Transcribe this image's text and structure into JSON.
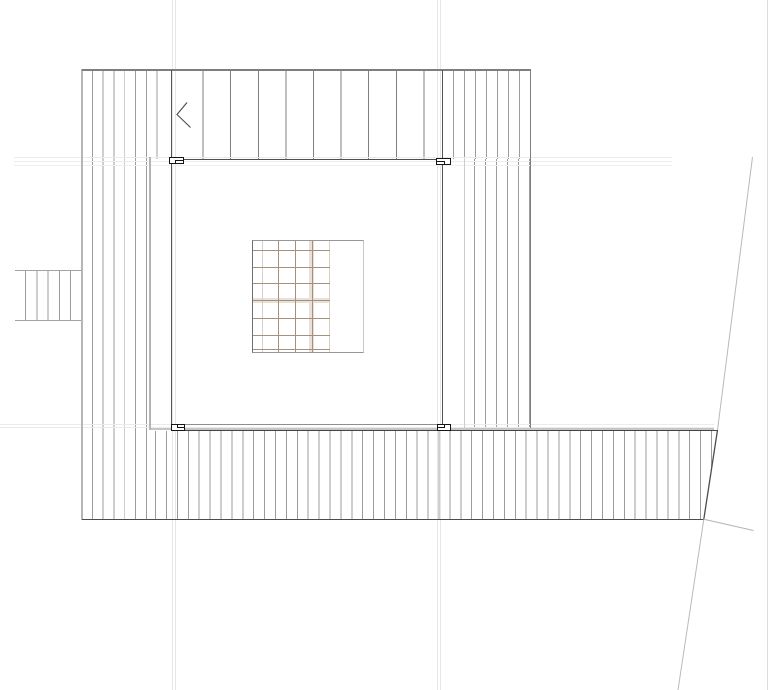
{
  "drawing": {
    "kind": "architectural plan view (roof/deck plan)",
    "background_color": "#ffffff",
    "colors": {
      "deck_board_hatch": "#9c9c9c",
      "deck_outer_edge_light": "#b6b6b6",
      "deck_edge_dark": "#4c4c4c",
      "stair_tread_line": "#7f7f7f",
      "room_wall_dark": "#4f4f4f",
      "room_outline_gray": "#b4b4b4",
      "guide_line": "#e9e9e9",
      "grate_tan_line": "#a5907b",
      "grate_beige_band": "#e9e1d9",
      "post_marker": "#151515",
      "boundary_line_light": "#b9b9b9",
      "boundary_line_dark": "#4d4d4d"
    },
    "features": {
      "stair_tread_lines": 9,
      "deck_board_spacing_px": 11,
      "post_markers": 4,
      "entry_stub_lines": 5,
      "grate_grid": {
        "columns": 5,
        "rows": 7
      },
      "direction_arrow": "chevron-left",
      "boundary": "diagonal site boundary on right side"
    }
  }
}
